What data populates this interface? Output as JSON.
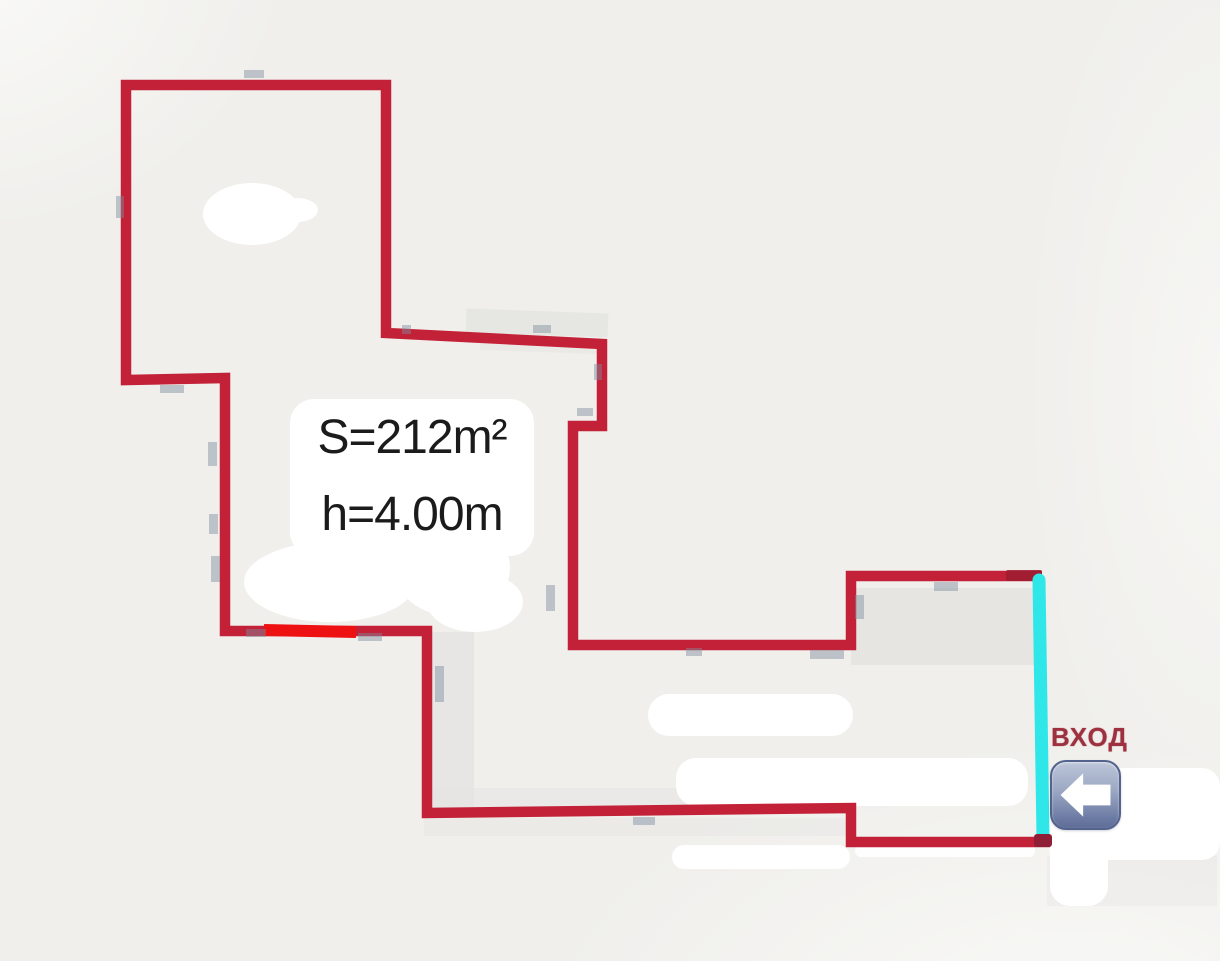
{
  "floorplan": {
    "area_label": "S=212m²",
    "height_label": "h=4.00m",
    "entrance_label": "ВХОД",
    "area_value_m2": 212,
    "ceiling_height_m": 4.0,
    "colors": {
      "background": "#f0efec",
      "wall_red": "#c32138",
      "marker_red": "#ee1111",
      "entrance_cyan": "#2fe7e9",
      "entrance_text": "#9d3140",
      "arrow_button_light": "#bcc5d8",
      "arrow_button_dark": "#5e6d97",
      "arrow_glyph": "#ffffff",
      "erase_white": "#ffffff",
      "underlay_gray": "#e4e3e1"
    },
    "icons": [
      {
        "name": "left-arrow-icon",
        "glyph": "⬅",
        "meaning": "entrance direction"
      }
    ]
  }
}
